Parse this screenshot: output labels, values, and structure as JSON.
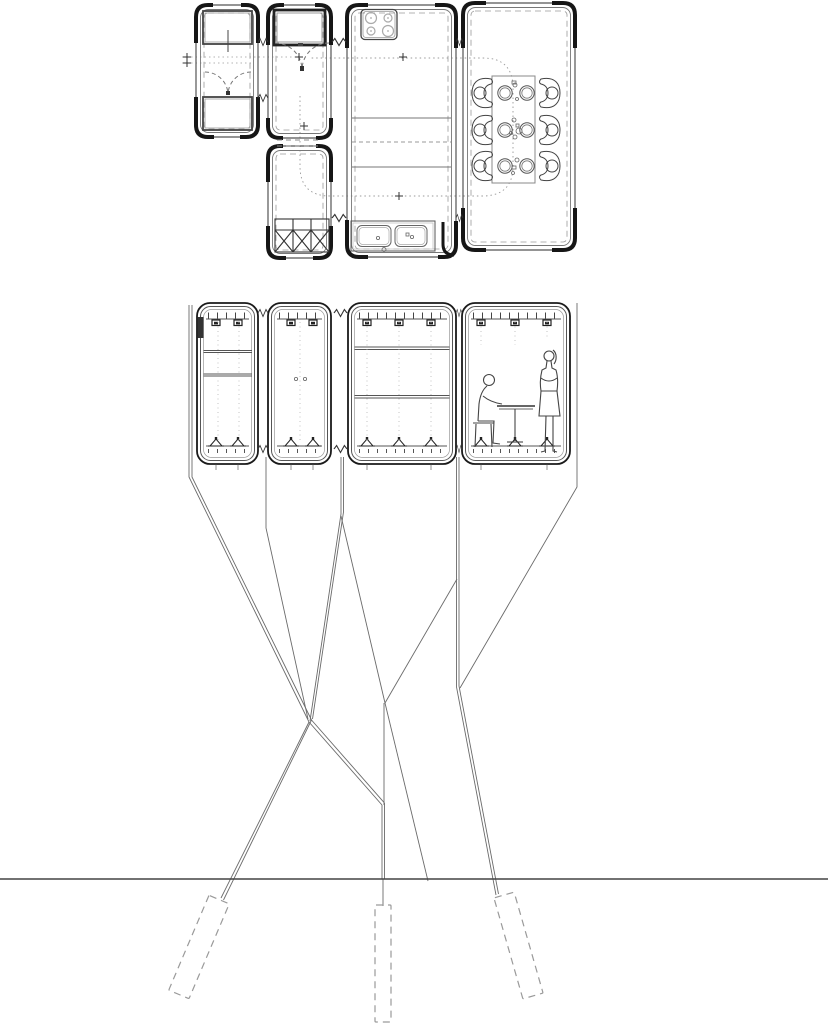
{
  "document": {
    "kind": "architectural line drawing",
    "plan_label": "floor plan of four linked modules",
    "section_label": "cross section of modules on legs with foundation piles",
    "background": "#ffffff"
  },
  "palette": {
    "line": "#4a4a4a",
    "wall": "#161616",
    "light": "#9a9a9a",
    "dashed": "#8a8a8a",
    "dotted": "#9a9a9a",
    "ground": "#3f3f3f"
  },
  "plan": {
    "modules": [
      {
        "name": "module-a",
        "furniture": [
          "bed",
          "bed",
          "double-swing-door"
        ]
      },
      {
        "name": "module-b",
        "furniture": [
          "platform-bed",
          "double-swing-door",
          "locker-grid-3-bays"
        ]
      },
      {
        "name": "module-c",
        "furniture": [
          "cooktop-4-burner",
          "two-counter-lines",
          "double-sink"
        ]
      },
      {
        "name": "module-d",
        "furniture": [
          "dining-table",
          "six-chairs",
          "six-plates"
        ]
      }
    ],
    "markers": {
      "plus_marks": 6,
      "break_symbols": 6,
      "circulation_path": "dotted loop from entry door through kitchen to dining table"
    }
  },
  "section": {
    "modules": 4,
    "shelf_modules": [
      "module-a",
      "module-c"
    ],
    "figures": [
      "seated-person-at-table",
      "standing-person"
    ],
    "roof_fixings_per_module": [
      2,
      2,
      3,
      3
    ],
    "floor_feet_per_module": [
      2,
      2,
      3,
      3
    ]
  },
  "structure": {
    "legs": [
      "left-outrigger",
      "prop-a-b",
      "prop-b-c",
      "prop-c-d",
      "right-outrigger"
    ],
    "ground_line_y_px": 879,
    "piles": [
      {
        "position": "left",
        "style": "dashed",
        "tilt_deg": 23
      },
      {
        "position": "center",
        "style": "dashed",
        "tilt_deg": 0
      },
      {
        "position": "right",
        "style": "dashed",
        "tilt_deg": -16
      }
    ]
  }
}
